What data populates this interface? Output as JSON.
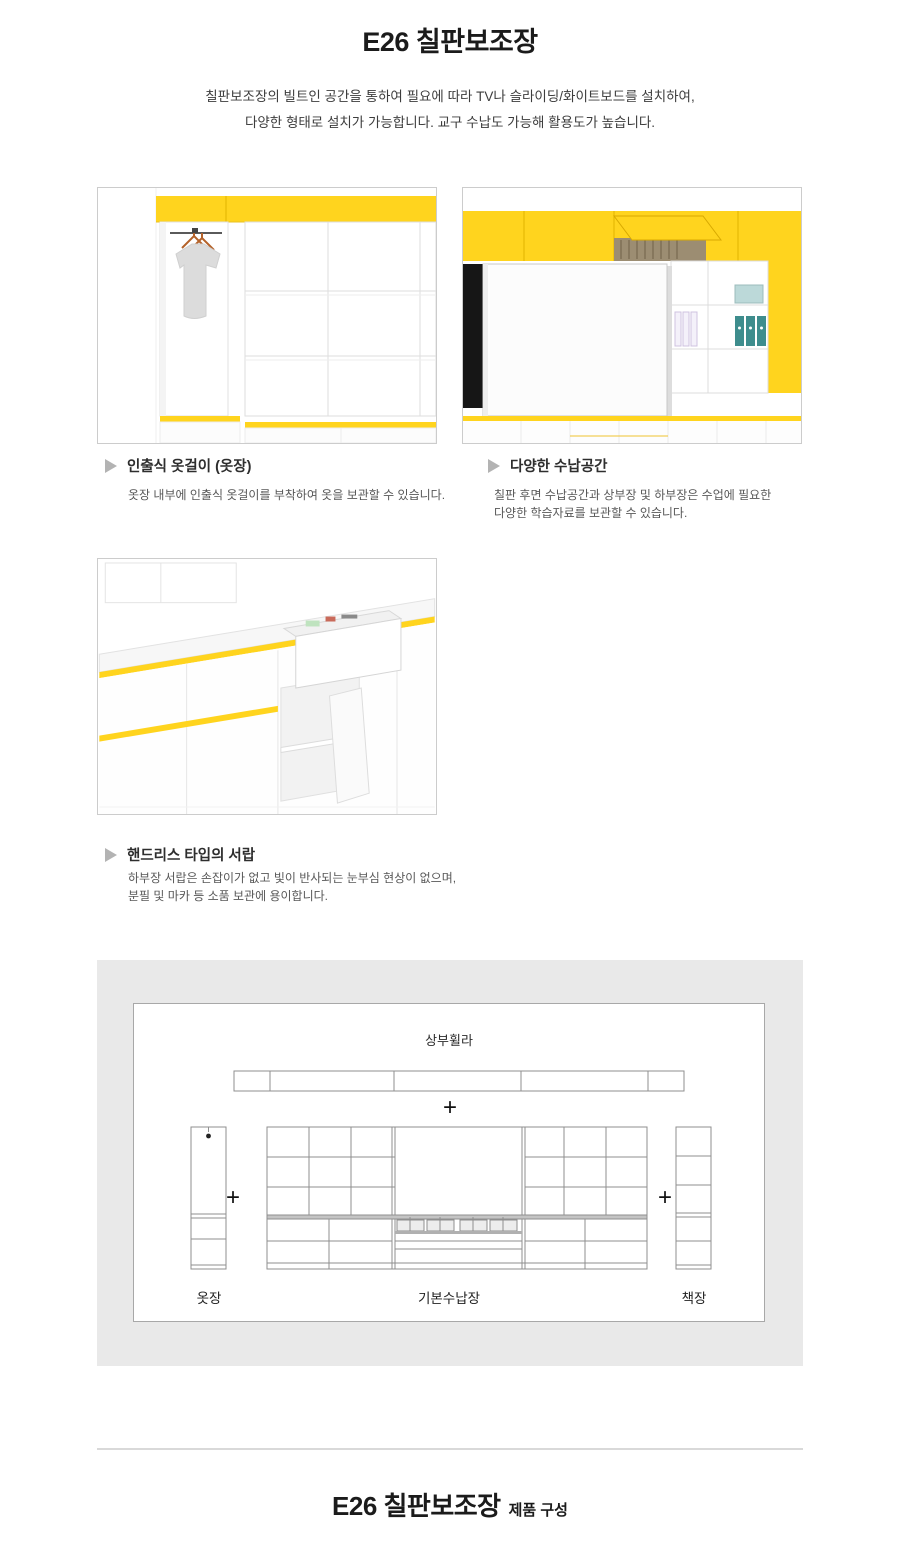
{
  "page": {
    "title": "E26 칠판보조장",
    "subtitle_line1": "칠판보조장의 빌트인 공간을 통하여 필요에 따라 TV나 슬라이딩/화이트보드를 설치하여,",
    "subtitle_line2": "다양한 형태로 설치가 가능합니다. 교구 수납도 가능해 활용도가 높습니다."
  },
  "features": [
    {
      "title": "인출식 옷걸이 (옷장)",
      "desc_line1": "옷장 내부에 인출식 옷걸이를 부착하여 옷을 보관할 수 있습니다.",
      "desc_line2": ""
    },
    {
      "title": "다양한 수납공간",
      "desc_line1": "칠판 후면 수납공간과 상부장 및 하부장은 수업에 필요한",
      "desc_line2": "다양한 학습자료를 보관할 수 있습니다."
    },
    {
      "title": "핸드리스 타입의 서랍",
      "desc_line1": "하부장 서랍은 손잡이가 없고 빛이 반사되는 눈부심 현상이 없으며,",
      "desc_line2": "분필 및 마카 등 소품 보관에 용이합니다."
    }
  ],
  "composition": {
    "top_label": "상부휠라",
    "plus": "+",
    "labels": {
      "wardrobe": "옷장",
      "main": "기본수납장",
      "bookcase": "책장"
    }
  },
  "footer": {
    "title": "E26 칠판보조장",
    "suffix": "제품 구성"
  },
  "icons": {
    "feature_bullet": "triangle-right"
  },
  "colors": {
    "accent_yellow": "#FFD41E",
    "section_gray": "#E9E9E9",
    "diagram_line": "#8F8F8F",
    "photo_border": "#CCCCCC",
    "tv_black": "#161616",
    "binder_teal": "#3E8D8D"
  }
}
